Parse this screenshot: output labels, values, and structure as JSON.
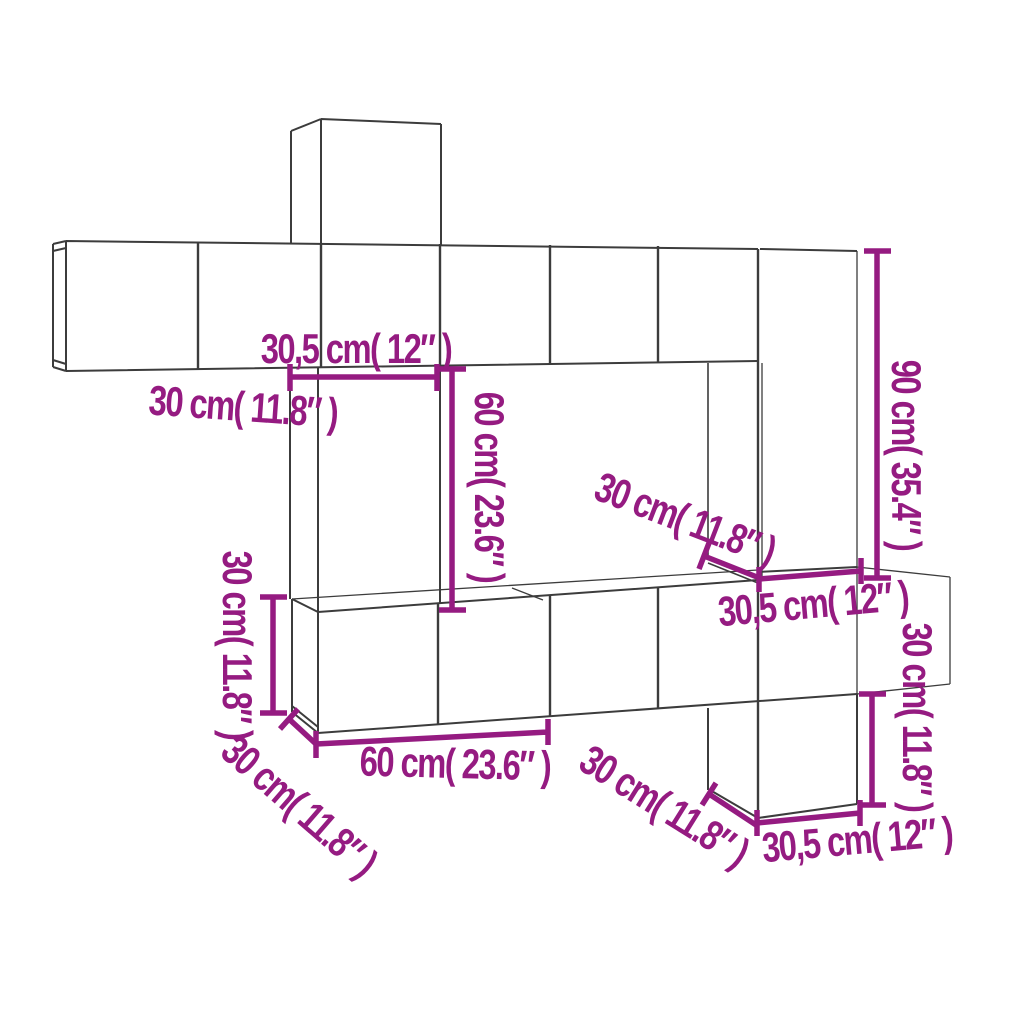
{
  "diagram": {
    "kind": "furniture-dimension-diagram",
    "subject": "wall-mounted-cabinet-set-line-drawing",
    "background": "#FFFFFF"
  },
  "colors": {
    "dimension_annotation": "#951B81",
    "drawing_line": "#3C3C3C"
  },
  "labels": {
    "top_width": "30,5 cm( 12″ )",
    "top_left": "30 cm( 11.8″ )",
    "left_cabinet_height": "60 cm( 23.6″ )",
    "right_cabinet_depth": "30 cm( 11.8″ )",
    "tall_cabinet_height": "90 cm( 35.4″ )",
    "row_height_left": "30 cm( 11.8″ )",
    "row_depth_left": "30 cm( 11.8″ )",
    "row_width_bottom": "60 cm( 23.6″ )",
    "bottom_cabinet_depth": "30 cm( 11.8″ )",
    "right_cabinet_width": "30,5 cm( 12″ )",
    "bottom_cabinet_height": "30 cm( 11.8″ )",
    "bottom_cabinet_width": "30,5 cm( 12″ )"
  }
}
